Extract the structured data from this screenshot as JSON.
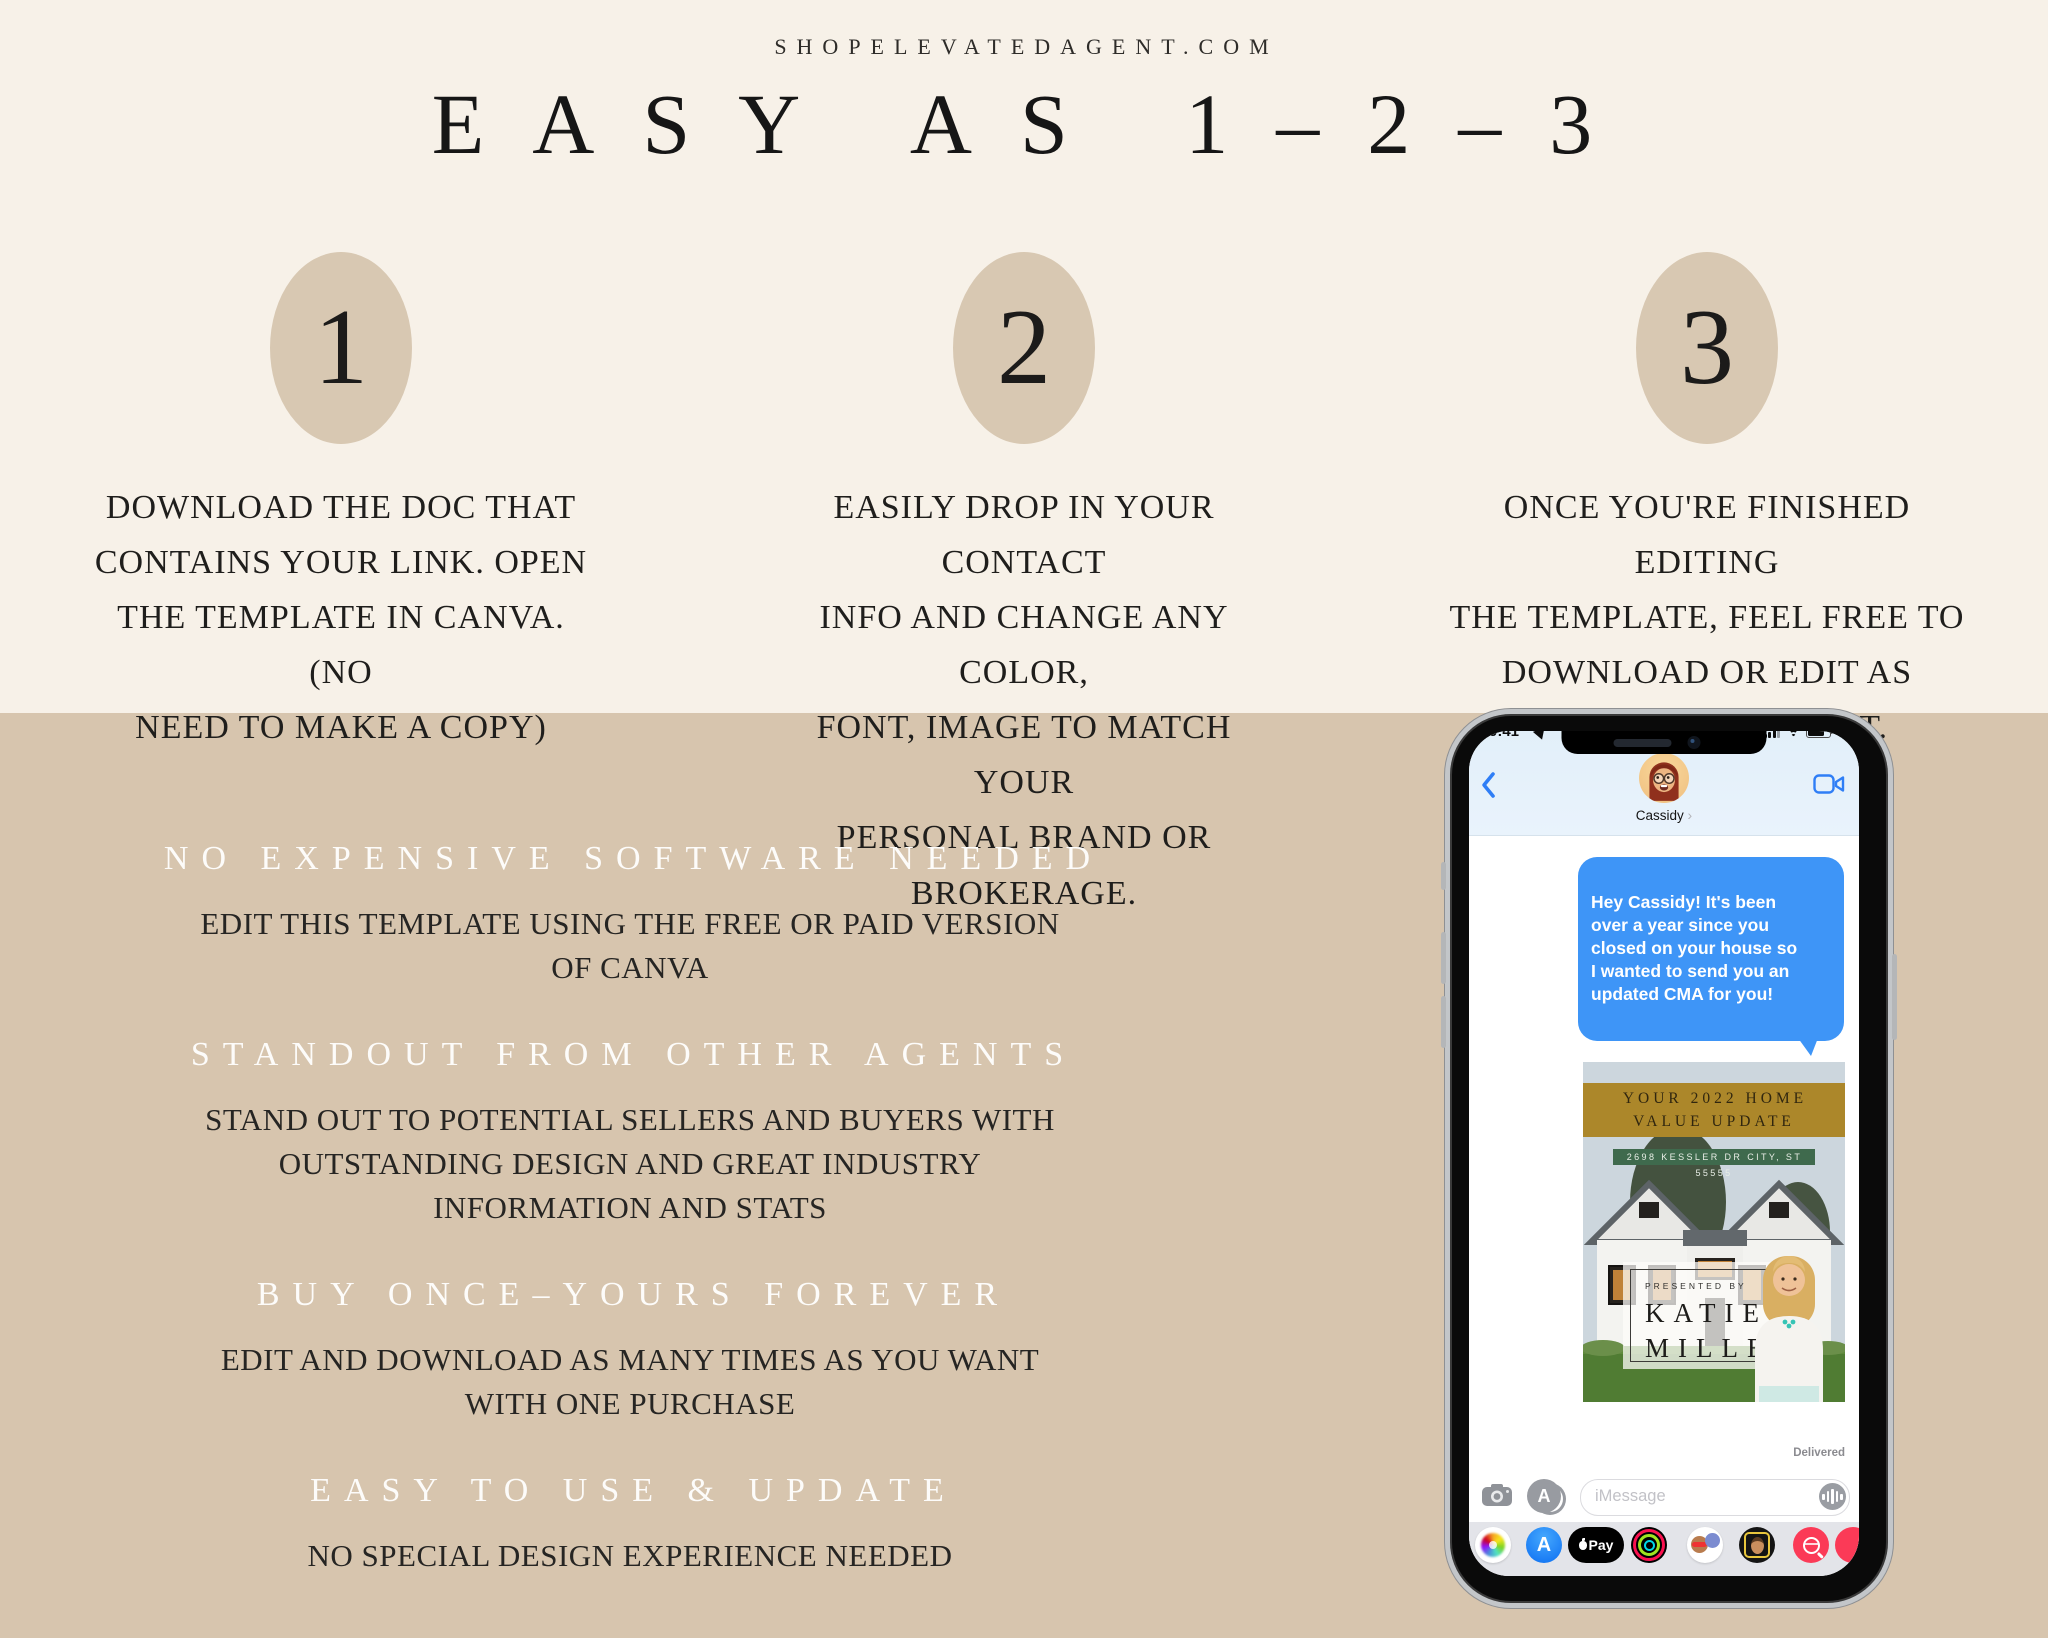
{
  "page": {
    "site": "SHOPELEVATEDAGENT.COM",
    "title": "EASY AS 1–2–3"
  },
  "steps": [
    {
      "number": "1",
      "text": "DOWNLOAD THE DOC THAT\nCONTAINS YOUR LINK. OPEN\nTHE TEMPLATE IN CANVA. (NO\nNEED TO MAKE A COPY)"
    },
    {
      "number": "2",
      "text": "EASILY DROP IN YOUR CONTACT\nINFO AND CHANGE ANY COLOR,\nFONT, IMAGE TO MATCH YOUR\nPERSONAL BRAND OR BROKERAGE."
    },
    {
      "number": "3",
      "text": "ONCE YOU'RE FINISHED EDITING\nTHE TEMPLATE, FEEL FREE TO\nDOWNLOAD OR EDIT AS\nMUCH AS YOU WANT."
    }
  ],
  "benefits": [
    {
      "heading": "NO EXPENSIVE SOFTWARE NEEDED",
      "body": "EDIT THIS TEMPLATE USING THE FREE OR PAID VERSION\nOF CANVA"
    },
    {
      "heading": "STANDOUT FROM OTHER AGENTS",
      "body": "STAND OUT TO POTENTIAL SELLERS AND BUYERS WITH\nOUTSTANDING DESIGN AND GREAT INDUSTRY\nINFORMATION AND STATS"
    },
    {
      "heading": "BUY ONCE–YOURS FOREVER",
      "body": "EDIT AND DOWNLOAD AS MANY TIMES AS YOU WANT\nWITH ONE PURCHASE"
    },
    {
      "heading": "EASY TO USE & UPDATE",
      "body": "NO SPECIAL DESIGN EXPERIENCE NEEDED"
    }
  ],
  "phone": {
    "status": {
      "time": "9:41"
    },
    "contact": {
      "name": "Cassidy",
      "chevron": "›"
    },
    "message": {
      "text": "Hey Cassidy! It's been\nover a year since you\nclosed on your house so\nI wanted to send you an\nupdated CMA for you!",
      "status": "Delivered"
    },
    "card": {
      "banner": "YOUR 2022 HOME\nVALUE UPDATE",
      "address": "2698 KESSLER DR CITY, ST 55555",
      "presented_by": "PRESENTED BY",
      "agent_first": "KATIE",
      "agent_last": "MILLER"
    },
    "composer": {
      "placeholder": "iMessage"
    },
    "apps": {
      "apple_pay_label": "Pay",
      "app_store_letter": "A"
    }
  },
  "icons": {
    "back": "chevron-left",
    "video": "video-camera",
    "camera": "camera",
    "appstore": "app-store",
    "audio": "waveform",
    "search": "magnifier-globe"
  },
  "colors": {
    "cream": "#f7f1e8",
    "beige": "#d7c5ae",
    "circle": "#d8c8b2",
    "gold_banner": "#ac872a",
    "green_banner": "#3f6a4d",
    "bubble_blue": "#3e95f7",
    "drawer_gray": "#e3e4e9",
    "red_app": "#fb3a57"
  }
}
